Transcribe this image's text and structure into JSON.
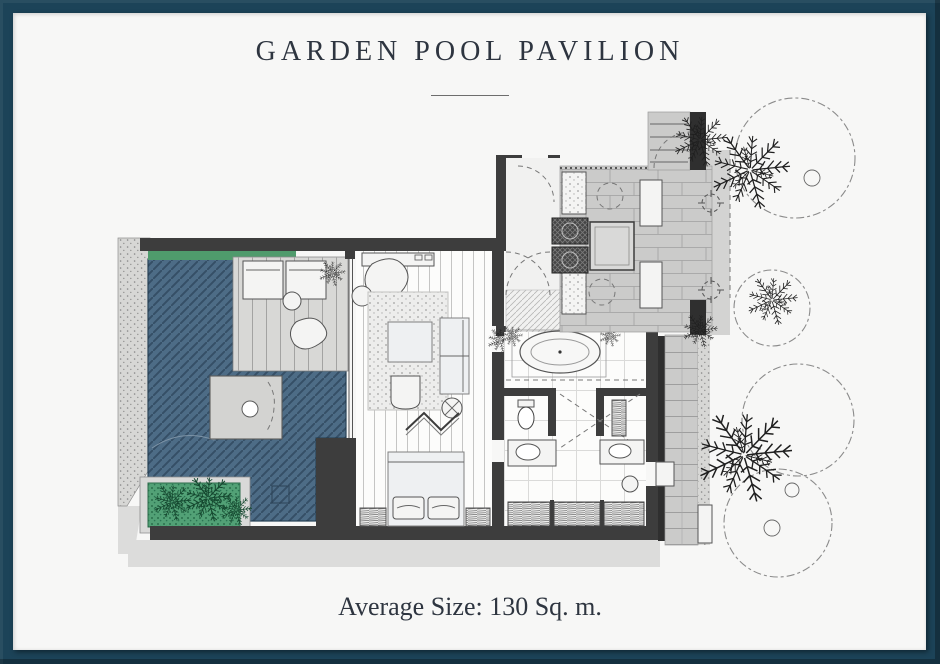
{
  "page": {
    "title": "GARDEN POOL PAVILION",
    "footer": "Average Size: 130 Sq. m."
  },
  "plan": {
    "colors": {
      "frame": "#1c4358",
      "page_bg": "#f7f7f6",
      "ink": "#2e3540",
      "pool": "#4d6c86",
      "pool_line": "#2b4559",
      "greenery": "#53a377",
      "hedge": "#4f9b6c",
      "wall": "#3d3d3d",
      "paving": "#cbcbca",
      "deck": "#d8d8d6",
      "platform": "#d3d3d1",
      "shadow": "#dcdcdb"
    },
    "features": [
      "swimming-pool",
      "pool-deck",
      "sun-loungers",
      "pool-daybed-platform",
      "garden-planter",
      "garden-path",
      "bedroom",
      "king-bed",
      "sofa",
      "coffee-table",
      "armchair",
      "folding-screen",
      "bathroom",
      "bathtub",
      "double-vanity",
      "toilet",
      "shower",
      "wardrobe",
      "entry-foyer",
      "entry-courtyard",
      "entry-steps",
      "palm-trees",
      "tree-canopies"
    ]
  }
}
